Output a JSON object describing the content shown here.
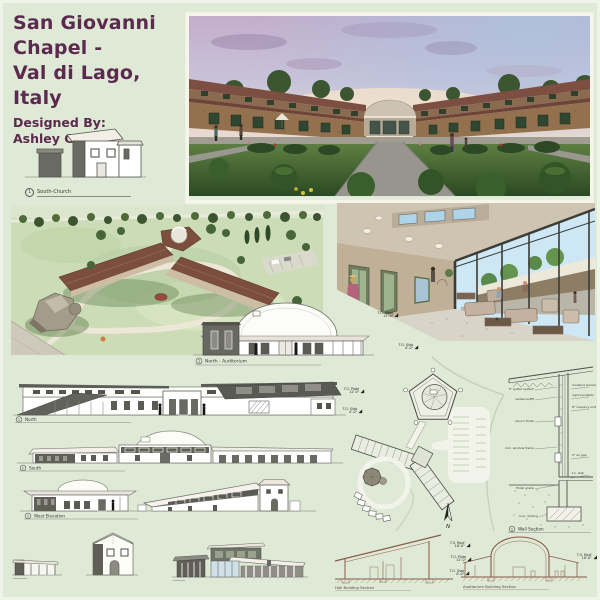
{
  "board": {
    "title_line1": "San Giovanni",
    "title_line2": "Chapel -",
    "title_line3": "Val di Lago, Italy",
    "byline_label": "Designed By:",
    "byline_name": "Ashley Gentile"
  },
  "colors": {
    "background": "#dee9d6",
    "title_text": "#5b2a4e",
    "drawing_line": "#55554e",
    "section_line": "#8a5a48",
    "roof_brown": "#7b4e3e",
    "grass_green": "#3f6f33",
    "stone_wall": "#93714f"
  },
  "labels": {
    "num1": "1",
    "south_church": "South-Church",
    "north_auditorium": "North - Auditorium",
    "north": "North",
    "south": "South",
    "west_elevation": "West Elevation",
    "wall_section": "Wall Section",
    "hall_section": "Hall Building Section",
    "auditorium_section": "Auditorium Building Section"
  },
  "markers": {
    "roof": {
      "name": "T.O. Roof",
      "value": "18'-0\""
    },
    "plate": {
      "name": "T.O. Plate",
      "value": "12'-0\""
    },
    "slab": {
      "name": "T.O. Slab",
      "value": "0'-0\""
    }
  },
  "site_plan": {
    "north_arrow": "N"
  },
  "wall_notes": {
    "left": [
      "5\" gutter system",
      "vented soffit",
      "stucco finish",
      "alum. window frame",
      "flashing",
      "finish grade",
      "conc. footing"
    ],
    "right": [
      "moisture barrier",
      "rigid insulation",
      "8\" masonry unit",
      "2\" air gap",
      "t.o. slab"
    ]
  }
}
